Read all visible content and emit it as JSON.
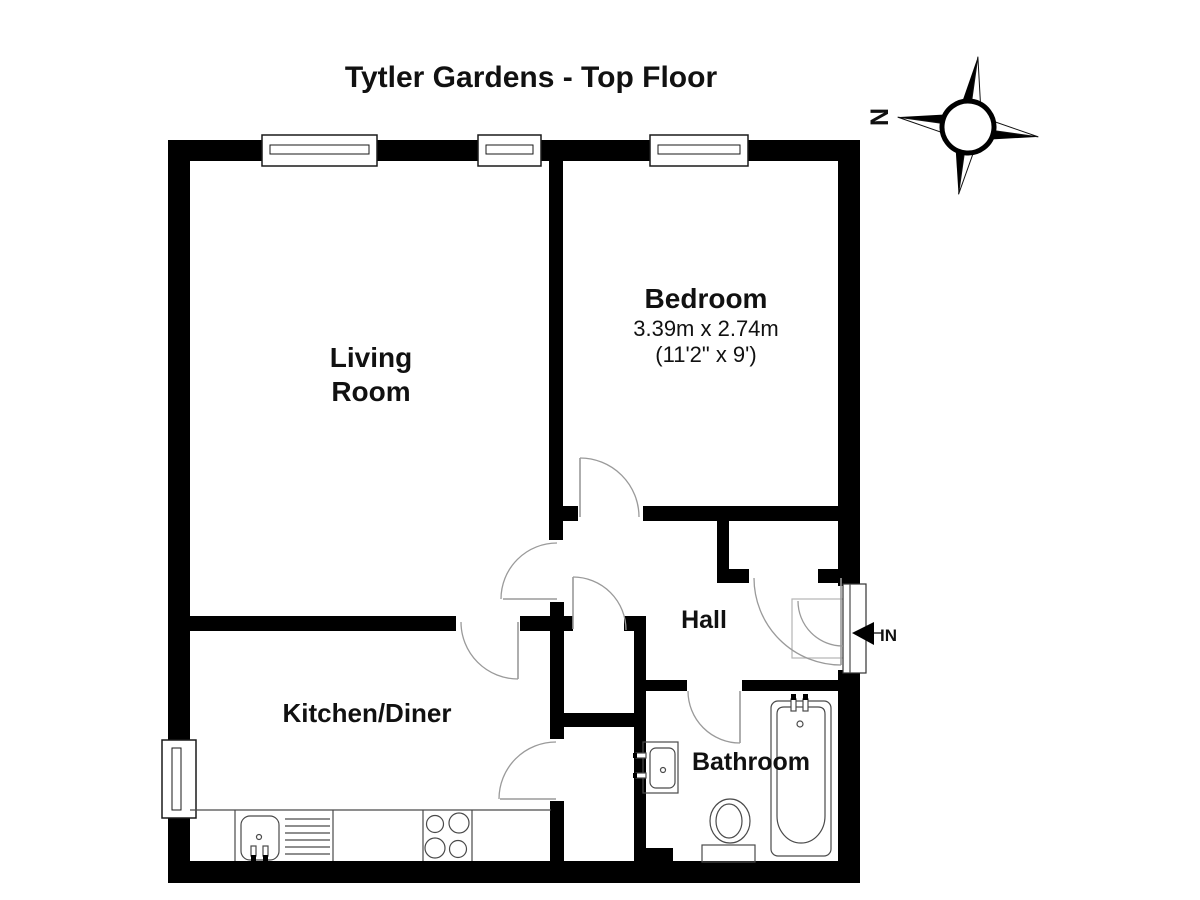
{
  "title": "Tytler Gardens - Top Floor",
  "labels": [
    {
      "id": "page-title",
      "text": "Tytler Gardens - Top Floor",
      "x": 531,
      "y": 87,
      "size": 30,
      "bold": true
    },
    {
      "id": "living-room-label-1",
      "text": "Living",
      "x": 371,
      "y": 367,
      "size": 28,
      "bold": true
    },
    {
      "id": "living-room-label-2",
      "text": "Room",
      "x": 371,
      "y": 401,
      "size": 28,
      "bold": true
    },
    {
      "id": "bedroom-label",
      "text": "Bedroom",
      "x": 706,
      "y": 308,
      "size": 28,
      "bold": true
    },
    {
      "id": "bedroom-dims-metric",
      "text": "3.39m x 2.74m",
      "x": 706,
      "y": 336,
      "size": 22,
      "bold": false
    },
    {
      "id": "bedroom-dims-imperial",
      "text": "(11'2\" x 9')",
      "x": 706,
      "y": 362,
      "size": 22,
      "bold": false
    },
    {
      "id": "kitchen-label",
      "text": "Kitchen/Diner",
      "x": 367,
      "y": 722,
      "size": 26,
      "bold": true
    },
    {
      "id": "hall-label",
      "text": "Hall",
      "x": 704,
      "y": 628,
      "size": 25,
      "bold": true
    },
    {
      "id": "bathroom-label",
      "text": "Bathroom",
      "x": 751,
      "y": 770,
      "size": 25,
      "bold": true
    },
    {
      "id": "entrance-in-label",
      "text": "IN",
      "x": 880,
      "y": 641,
      "size": 17,
      "bold": true,
      "anchor": "start"
    }
  ],
  "plan": {
    "wall_color": "#000000",
    "door_color": "#9a9a9a",
    "fixture_color": "#4a4a4a",
    "window_border": "#1a1a1a",
    "walls": [
      {
        "id": "outer-top",
        "x": 168,
        "y": 140,
        "w": 692,
        "h": 21
      },
      {
        "id": "outer-left",
        "x": 168,
        "y": 140,
        "w": 22,
        "h": 743
      },
      {
        "id": "outer-bottom",
        "x": 168,
        "y": 861,
        "w": 692,
        "h": 22
      },
      {
        "id": "outer-right",
        "x": 838,
        "y": 140,
        "w": 22,
        "h": 743
      },
      {
        "id": "partition-bedroom-west",
        "x": 549,
        "y": 158,
        "w": 14,
        "h": 382
      },
      {
        "id": "bedroom-south-stub",
        "x": 562,
        "y": 506,
        "w": 16,
        "h": 15
      },
      {
        "id": "bedroom-south-main",
        "x": 643,
        "y": 506,
        "w": 195,
        "h": 15
      },
      {
        "id": "hall-closet-west-stub",
        "x": 717,
        "y": 521,
        "w": 12,
        "h": 56
      },
      {
        "id": "hall-closet-south-bar",
        "x": 717,
        "y": 569,
        "w": 32,
        "h": 14
      },
      {
        "id": "hall-closet-east-stub",
        "x": 818,
        "y": 569,
        "w": 20,
        "h": 14
      },
      {
        "id": "living-kitchen-divider",
        "x": 190,
        "y": 616,
        "w": 266,
        "h": 15
      },
      {
        "id": "divider-cross-stub",
        "x": 520,
        "y": 616,
        "w": 53,
        "h": 15
      },
      {
        "id": "divider-east-stub",
        "x": 624,
        "y": 616,
        "w": 19,
        "h": 15
      },
      {
        "id": "kitchen-east-upper",
        "x": 550,
        "y": 602,
        "w": 14,
        "h": 137
      },
      {
        "id": "kitchen-east-lower",
        "x": 550,
        "y": 801,
        "w": 14,
        "h": 62
      },
      {
        "id": "cupboard-divider",
        "x": 563,
        "y": 713,
        "w": 83,
        "h": 14
      },
      {
        "id": "bathroom-west",
        "x": 634,
        "y": 616,
        "w": 12,
        "h": 232
      },
      {
        "id": "bathroom-west-foot",
        "x": 634,
        "y": 848,
        "w": 39,
        "h": 15
      },
      {
        "id": "bathroom-north-west",
        "x": 646,
        "y": 680,
        "w": 41,
        "h": 11
      },
      {
        "id": "bathroom-north-east",
        "x": 742,
        "y": 680,
        "w": 96,
        "h": 11
      }
    ],
    "windows": [
      {
        "id": "window-living-large",
        "x": 262,
        "y": 135,
        "w": 115,
        "h": 31,
        "o": "h"
      },
      {
        "id": "window-living-small",
        "x": 478,
        "y": 135,
        "w": 63,
        "h": 31,
        "o": "h"
      },
      {
        "id": "window-bedroom",
        "x": 650,
        "y": 135,
        "w": 98,
        "h": 31,
        "o": "h"
      },
      {
        "id": "window-kitchen",
        "x": 162,
        "y": 740,
        "w": 34,
        "h": 78,
        "o": "v"
      }
    ],
    "doors": [
      {
        "id": "door-bedroom",
        "leaf": [
          580,
          458,
          580,
          517
        ],
        "arc": "M 580,458 A 59,59 0 0 1 639,517"
      },
      {
        "id": "door-living-room",
        "leaf": [
          503,
          599,
          557,
          599
        ],
        "arc": "M 557,543 A 56,56 0 0 0 501,599"
      },
      {
        "id": "door-hall-cupboard",
        "leaf": [
          573,
          577,
          573,
          629
        ],
        "arc": "M 573,577 A 53,53 0 0 1 626,630"
      },
      {
        "id": "door-kitchen",
        "leaf": [
          518,
          622,
          518,
          679
        ],
        "arc": "M 461,622 A 57,57 0 0 0 518,679"
      },
      {
        "id": "door-kitchen-cupboard",
        "leaf": [
          500,
          799,
          556,
          799
        ],
        "arc": "M 556,742 A 57,57 0 0 0 499,799"
      },
      {
        "id": "door-bathroom",
        "leaf": [
          740,
          691,
          740,
          743
        ],
        "arc": "M 688,691 A 52,52 0 0 0 740,743"
      },
      {
        "id": "door-hall-closet",
        "leaf": [
          841,
          578,
          841,
          665
        ],
        "arc": "M 754,578 A 87,87 0 0 0 841,665"
      },
      {
        "id": "door-entrance",
        "leaf": null,
        "arc": "M 798,601 A 45,45 0 0 0 843,646"
      }
    ],
    "entrance": {
      "prims": [
        {
          "t": "rect",
          "x": 836,
          "y": 586,
          "w": 26,
          "h": 84,
          "fill": "#ffffff"
        },
        {
          "t": "rect",
          "x": 792,
          "y": 599,
          "w": 51,
          "h": 59,
          "stroke": "#b5b5b5"
        },
        {
          "t": "rect",
          "x": 843,
          "y": 584,
          "w": 23,
          "h": 89,
          "fill": "#ffffff",
          "stroke": "#333333"
        },
        {
          "t": "line",
          "x1": 850,
          "y1": 584,
          "x2": 850,
          "y2": 673
        }
      ],
      "arrow": [
        {
          "t": "poly",
          "pts": "852,633 874,622 874,645",
          "fill": "#000000"
        },
        {
          "t": "line",
          "x1": 874,
          "y1": 633,
          "x2": 882,
          "y2": 633,
          "stroke": "#000000"
        }
      ]
    },
    "fixtures": [
      {
        "id": "kitchen-counter",
        "prims": [
          {
            "t": "line",
            "x1": 190,
            "y1": 810,
            "x2": 551,
            "y2": 810
          },
          {
            "t": "line",
            "x1": 235,
            "y1": 810,
            "x2": 235,
            "y2": 861
          },
          {
            "t": "line",
            "x1": 333,
            "y1": 810,
            "x2": 333,
            "y2": 861
          },
          {
            "t": "line",
            "x1": 423,
            "y1": 810,
            "x2": 423,
            "y2": 861
          },
          {
            "t": "line",
            "x1": 472,
            "y1": 810,
            "x2": 472,
            "y2": 861
          }
        ]
      },
      {
        "id": "kitchen-sink",
        "prims": [
          {
            "t": "rect",
            "x": 241,
            "y": 816,
            "w": 38,
            "h": 44,
            "rx": 9,
            "stroke": "#4a4a4a"
          },
          {
            "t": "circle",
            "cx": 259,
            "cy": 837,
            "r": 2.5
          },
          {
            "t": "rect",
            "x": 251,
            "y": 846,
            "w": 5,
            "h": 10,
            "fill": "#ffffff",
            "stroke": "#4a4a4a"
          },
          {
            "t": "rect",
            "x": 251,
            "y": 855,
            "w": 5,
            "h": 6,
            "fill": "#000000"
          },
          {
            "t": "rect",
            "x": 263,
            "y": 846,
            "w": 5,
            "h": 10,
            "fill": "#ffffff",
            "stroke": "#4a4a4a"
          },
          {
            "t": "rect",
            "x": 263,
            "y": 855,
            "w": 5,
            "h": 6,
            "fill": "#000000"
          },
          {
            "t": "line",
            "x1": 285,
            "y1": 819,
            "x2": 330,
            "y2": 819
          },
          {
            "t": "line",
            "x1": 285,
            "y1": 826,
            "x2": 330,
            "y2": 826
          },
          {
            "t": "line",
            "x1": 285,
            "y1": 833,
            "x2": 330,
            "y2": 833
          },
          {
            "t": "line",
            "x1": 285,
            "y1": 840,
            "x2": 330,
            "y2": 840
          },
          {
            "t": "line",
            "x1": 285,
            "y1": 847,
            "x2": 330,
            "y2": 847
          },
          {
            "t": "line",
            "x1": 285,
            "y1": 854,
            "x2": 330,
            "y2": 854
          }
        ]
      },
      {
        "id": "kitchen-hob",
        "prims": [
          {
            "t": "circle",
            "cx": 435,
            "cy": 824,
            "r": 8.5
          },
          {
            "t": "circle",
            "cx": 459,
            "cy": 823,
            "r": 10
          },
          {
            "t": "circle",
            "cx": 435,
            "cy": 848,
            "r": 10
          },
          {
            "t": "circle",
            "cx": 458,
            "cy": 849,
            "r": 8.5
          }
        ]
      },
      {
        "id": "bathroom-basin",
        "prims": [
          {
            "t": "rect",
            "x": 643,
            "y": 742,
            "w": 35,
            "h": 51,
            "stroke": "#4a4a4a"
          },
          {
            "t": "rect",
            "x": 650,
            "y": 748,
            "w": 25,
            "h": 40,
            "rx": 6,
            "stroke": "#4a4a4a"
          },
          {
            "t": "circle",
            "cx": 663,
            "cy": 770,
            "r": 2.5
          },
          {
            "t": "rect",
            "x": 636,
            "y": 753,
            "w": 10,
            "h": 5,
            "fill": "#ffffff",
            "stroke": "#4a4a4a"
          },
          {
            "t": "rect",
            "x": 633,
            "y": 753,
            "w": 4,
            "h": 5,
            "fill": "#000000"
          },
          {
            "t": "rect",
            "x": 636,
            "y": 773,
            "w": 10,
            "h": 5,
            "fill": "#ffffff",
            "stroke": "#4a4a4a"
          },
          {
            "t": "rect",
            "x": 633,
            "y": 773,
            "w": 4,
            "h": 5,
            "fill": "#000000"
          }
        ]
      },
      {
        "id": "toilet",
        "prims": [
          {
            "t": "rect",
            "x": 702,
            "y": 845,
            "w": 53,
            "h": 17,
            "stroke": "#4a4a4a"
          },
          {
            "t": "ellipse",
            "cx": 730,
            "cy": 821,
            "rx": 20,
            "ry": 22
          },
          {
            "t": "ellipse",
            "cx": 729,
            "cy": 821,
            "rx": 13,
            "ry": 17
          }
        ]
      },
      {
        "id": "bathtub",
        "prims": [
          {
            "t": "rect",
            "x": 771,
            "y": 701,
            "w": 60,
            "h": 155,
            "rx": 7,
            "stroke": "#4a4a4a"
          },
          {
            "t": "path",
            "d": "M 777,714 Q 777,707 784,707 L 818,707 Q 825,707 825,714 L 825,816 A 24,27 0 0 1 777,816 Z"
          },
          {
            "t": "rect",
            "x": 791,
            "y": 699,
            "w": 5,
            "h": 12,
            "fill": "#ffffff",
            "stroke": "#4a4a4a"
          },
          {
            "t": "rect",
            "x": 791,
            "y": 694,
            "w": 5,
            "h": 6,
            "fill": "#000000"
          },
          {
            "t": "rect",
            "x": 803,
            "y": 699,
            "w": 5,
            "h": 12,
            "fill": "#ffffff",
            "stroke": "#4a4a4a"
          },
          {
            "t": "rect",
            "x": 803,
            "y": 694,
            "w": 5,
            "h": 6,
            "fill": "#000000"
          },
          {
            "t": "circle",
            "cx": 800,
            "cy": 724,
            "r": 3
          }
        ]
      }
    ]
  },
  "compass": {
    "label": "N",
    "cx": 968,
    "cy": 127,
    "r": 26,
    "rotation": 8,
    "spike": 71,
    "half": 14,
    "label_x": 888,
    "label_y": 117,
    "label_size": 25
  }
}
